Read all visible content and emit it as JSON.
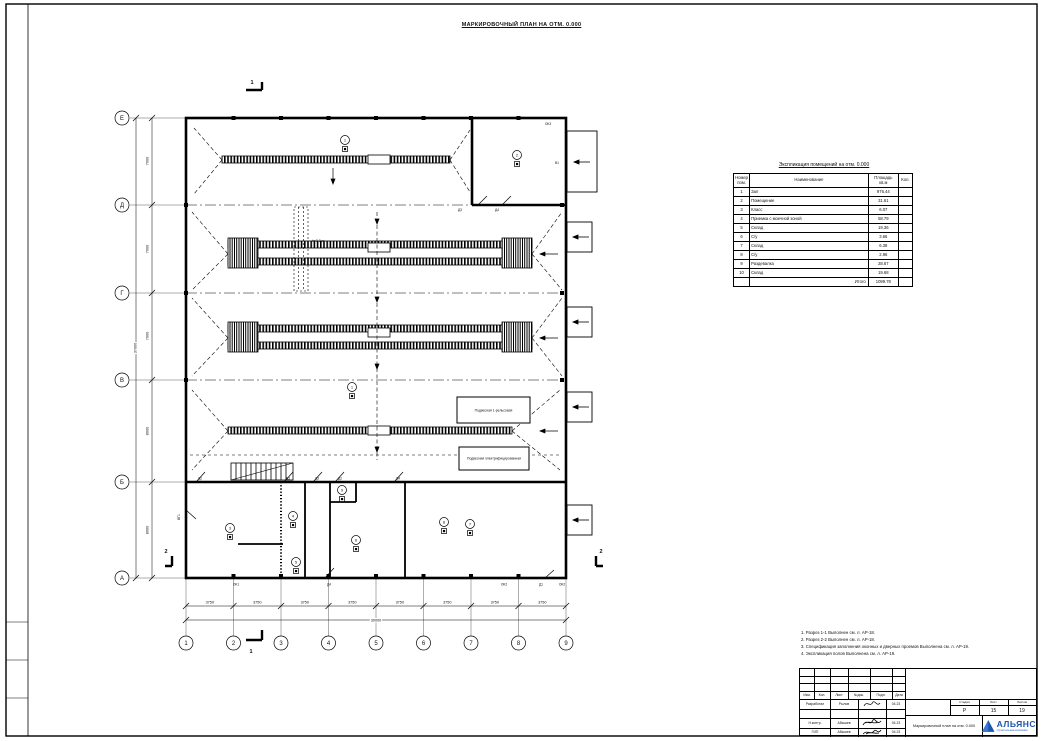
{
  "sheet_title": "МАРКИРОВОЧНЫЙ ПЛАН НА ОТМ. 0.000",
  "plan": {
    "row_axes": [
      "Е",
      "Д",
      "Г",
      "В",
      "Б",
      "А"
    ],
    "col_axes": [
      "1",
      "2",
      "3",
      "4",
      "5",
      "6",
      "7",
      "8",
      "9"
    ],
    "dims_left": [
      "7000",
      "7000",
      "7000",
      "8000",
      "8000"
    ],
    "dim_left_total": "37000",
    "dims_bottom": [
      "3750",
      "3750",
      "3750",
      "3750",
      "3750",
      "3750",
      "3750",
      "3750"
    ],
    "dim_bottom_total": "30000",
    "section_marks": [
      "1",
      "1",
      "2",
      "2"
    ],
    "height_note": "h=3,2 м",
    "callouts": [
      "Подвесная 1-рельсовая",
      "Подвесная электрифицированная"
    ],
    "markers": [
      "1",
      "2",
      "1",
      "3",
      "4",
      "5",
      "6",
      "9",
      "7",
      "8"
    ],
    "openings": [
      "ОК3",
      "В1",
      "Д3",
      "Д4",
      "Д2",
      "Д3",
      "Д3",
      "Д2",
      "Д4",
      "ВГ1",
      "ОК1",
      "Д4",
      "ОК2",
      "Д1",
      "ОК2"
    ]
  },
  "schedule": {
    "title": "Экспликация помещений на отм. 0.000",
    "headers": {
      "num": "Номер пом.",
      "name": "Наименование",
      "area": "Площадь кв.м",
      "qty": "Кол."
    },
    "rows": [
      [
        "1",
        "Зал",
        "976.44"
      ],
      [
        "2",
        "Помещение",
        "31.61"
      ],
      [
        "3",
        "Класс",
        "6.07"
      ],
      [
        "4",
        "Приемка с моечной зоной",
        "58.79"
      ],
      [
        "5",
        "Склад",
        "19.36"
      ],
      [
        "6",
        "С/у",
        "3.66"
      ],
      [
        "7",
        "Склад",
        "6.38"
      ],
      [
        "8",
        "С/у",
        "2.96"
      ],
      [
        "9",
        "Раздевалка",
        "28.67"
      ],
      [
        "10",
        "Склад",
        "19.68"
      ]
    ],
    "total_label": "Итого",
    "total_value": "1099.78"
  },
  "notes": [
    "1. Разрез 1-1 Выполнен см. л. АР-18.",
    "2. Разрез 2-2 Выполнен см. л. АР-18.",
    "3. Спецификация заполнения оконных и дверных проемов Выполнена см. л. АР-19.",
    "4. Экспликация полов Выполнена см. л. АР-19."
  ],
  "titleblock": {
    "header_cols": [
      "Изм.",
      "Кол.",
      "Лист",
      "№док.",
      "Подп.",
      "Дата"
    ],
    "roles": [
      {
        "role": "Разработал",
        "name": "Рылов",
        "date": "04.23"
      },
      {
        "role": "",
        "name": "",
        "date": ""
      },
      {
        "role": "Н.контр.",
        "name": "Абышев",
        "date": "04.23"
      },
      {
        "role": "ГИП",
        "name": "Абышев",
        "date": "04.23"
      }
    ],
    "stage_label": "Стадия",
    "sheet_label": "Лист",
    "sheets_label": "Листов",
    "stage": "Р",
    "sheet": "15",
    "sheets": "19",
    "doc_name": "Маркировочный план на отм. 0.000",
    "company": "АЛЬЯНС",
    "company_sub": "строительная компания",
    "logo_color": "#1b57ad"
  }
}
